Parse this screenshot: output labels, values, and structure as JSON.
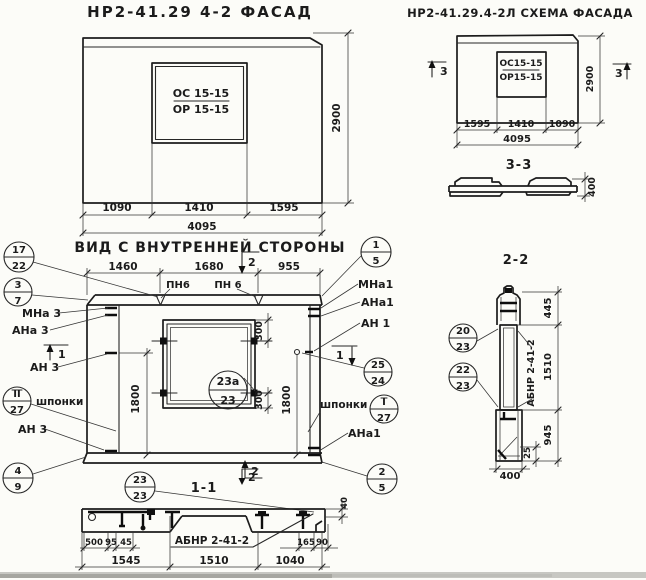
{
  "facade": {
    "title": "НР2-41.29 4-2 ФАСАД",
    "window_mark_top": "ОС 15-15",
    "window_mark_bottom": "ОР 15-15",
    "dim_left": "1090",
    "dim_mid": "1410",
    "dim_right": "1595",
    "dim_total": "4095",
    "dim_height": "2900"
  },
  "scheme": {
    "title": "НР2-41.29.4-2Л СХЕМА ФАСАДА",
    "window_mark_top": "ОС15-15",
    "window_mark_bottom": "ОР15-15",
    "dim_left": "1595",
    "dim_mid": "1410",
    "dim_right": "1090",
    "dim_total": "4095",
    "dim_height": "2900",
    "flag": "3",
    "section_title": "3-3",
    "section_dim": "400"
  },
  "inner": {
    "title": "ВИД С ВНУТРЕННЕЙ СТОРОНЫ",
    "dim_top_left": "1460",
    "dim_top_mid": "1680",
    "dim_top_right": "955",
    "dim_left_v": "1800",
    "dim_right_v": "1800",
    "dim_win_top": "300",
    "dim_win_bottom": "300",
    "pn_label_1": "ПН6",
    "pn_label_2": "ПН 6",
    "label_mna3": "МНа 3",
    "label_ana3": "АНа 3",
    "label_an3": "АН 3",
    "label_shponki_left": "шпонки",
    "label_an3_bottom": "АН 3",
    "label_mna1": "МНа1",
    "label_ana1": "АНа1",
    "label_an1": "АН 1",
    "label_shponki_right": "шпонки",
    "label_ana1_bottom": "АНа1",
    "flag_1": "1",
    "flag_2": "2",
    "title_s11": "1-1"
  },
  "section11": {
    "label": "АБНР 2-41-2",
    "flag": "2",
    "dim_500": "500",
    "dim_95": "95",
    "dim_45": "45",
    "dim_165": "165",
    "dim_90": "90",
    "dim_40": "40",
    "dim_1545": "1545",
    "dim_1510": "1510",
    "dim_1040": "1040"
  },
  "section22": {
    "title": "2-2",
    "label_vertical": "АБНР 2-41-2",
    "dim_445": "445",
    "dim_1510": "1510",
    "dim_945": "945",
    "dim_25": "25",
    "dim_400": "400"
  },
  "markers": {
    "m17_22": {
      "top": "17",
      "bottom": "22"
    },
    "m3_7": {
      "top": "3",
      "bottom": "7"
    },
    "m4_9": {
      "top": "4",
      "bottom": "9"
    },
    "mII_27": {
      "top": "II",
      "bottom": "27"
    },
    "m1_5": {
      "top": "1",
      "bottom": "5"
    },
    "m25_24": {
      "top": "25",
      "bottom": "24"
    },
    "mI_27": {
      "top": "I",
      "bottom": "27"
    },
    "m2_5": {
      "top": "2",
      "bottom": "5"
    },
    "m23a_23": {
      "top": "23а",
      "bottom": "23"
    },
    "m23_23": {
      "top": "23",
      "bottom": "23"
    },
    "m20_23": {
      "top": "20",
      "bottom": "23"
    },
    "m22_23": {
      "top": "22",
      "bottom": "23"
    }
  }
}
